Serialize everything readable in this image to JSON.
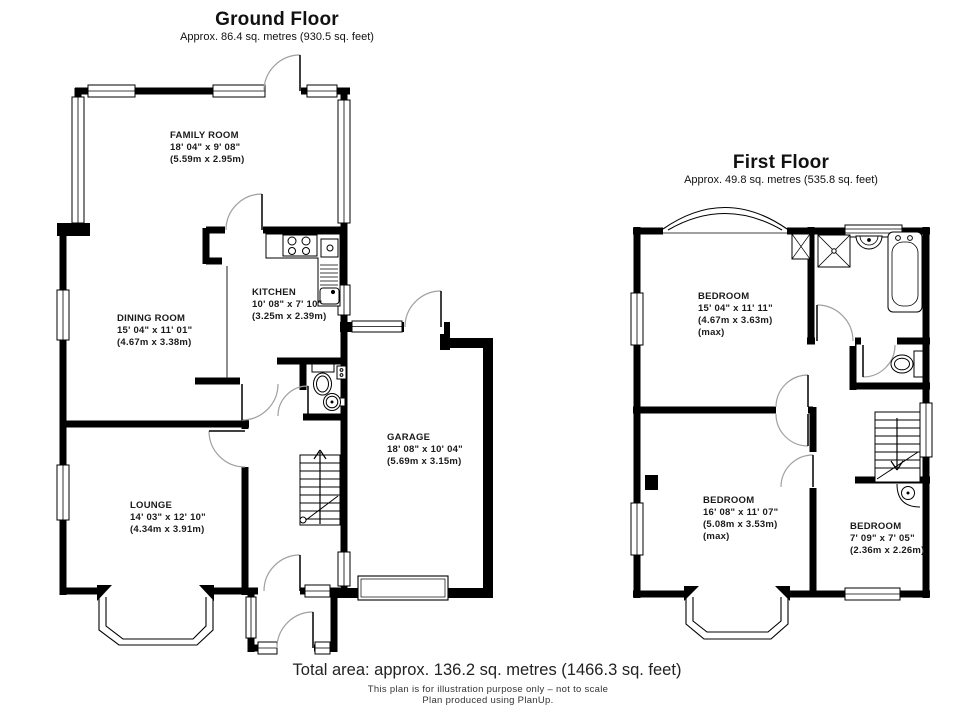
{
  "ground_floor": {
    "title": "Ground Floor",
    "subtitle": "Approx. 86.4 sq. metres (930.5 sq. feet)",
    "rooms": [
      {
        "name": "FAMILY ROOM",
        "dim_ft": "18' 04\" x 9' 08\"",
        "dim_m": "(5.59m x 2.95m)"
      },
      {
        "name": "DINING ROOM",
        "dim_ft": "15' 04\" x 11' 01\"",
        "dim_m": "(4.67m x 3.38m)"
      },
      {
        "name": "KITCHEN",
        "dim_ft": "10' 08\" x 7' 10\"",
        "dim_m": "(3.25m x 2.39m)"
      },
      {
        "name": "LOUNGE",
        "dim_ft": "14' 03\" x 12' 10\"",
        "dim_m": "(4.34m x 3.91m)"
      },
      {
        "name": "GARAGE",
        "dim_ft": "18' 08\" x 10' 04\"",
        "dim_m": "(5.69m x 3.15m)"
      }
    ]
  },
  "first_floor": {
    "title": "First Floor",
    "subtitle": "Approx. 49.8 sq. metres (535.8 sq. feet)",
    "rooms": [
      {
        "name": "BEDROOM",
        "dim_ft": "15' 04\" x 11' 11\"",
        "dim_m": "(4.67m x 3.63m)",
        "note": "(max)"
      },
      {
        "name": "BEDROOM",
        "dim_ft": "16' 08\" x 11' 07\"",
        "dim_m": "(5.08m x 3.53m)",
        "note": "(max)"
      },
      {
        "name": "BEDROOM",
        "dim_ft": "7' 09\" x 7' 05\"",
        "dim_m": "(2.36m x 2.26m)"
      }
    ]
  },
  "footer": {
    "total": "Total area: approx. 136.2 sq. metres (1466.3 sq. feet)",
    "disclaimer": "This plan is for illustration purpose only – not to scale",
    "credit": "Plan produced using PlanUp."
  },
  "colors": {
    "wall": "#000000",
    "background": "#ffffff",
    "door_arc": "#a0a0a0"
  }
}
